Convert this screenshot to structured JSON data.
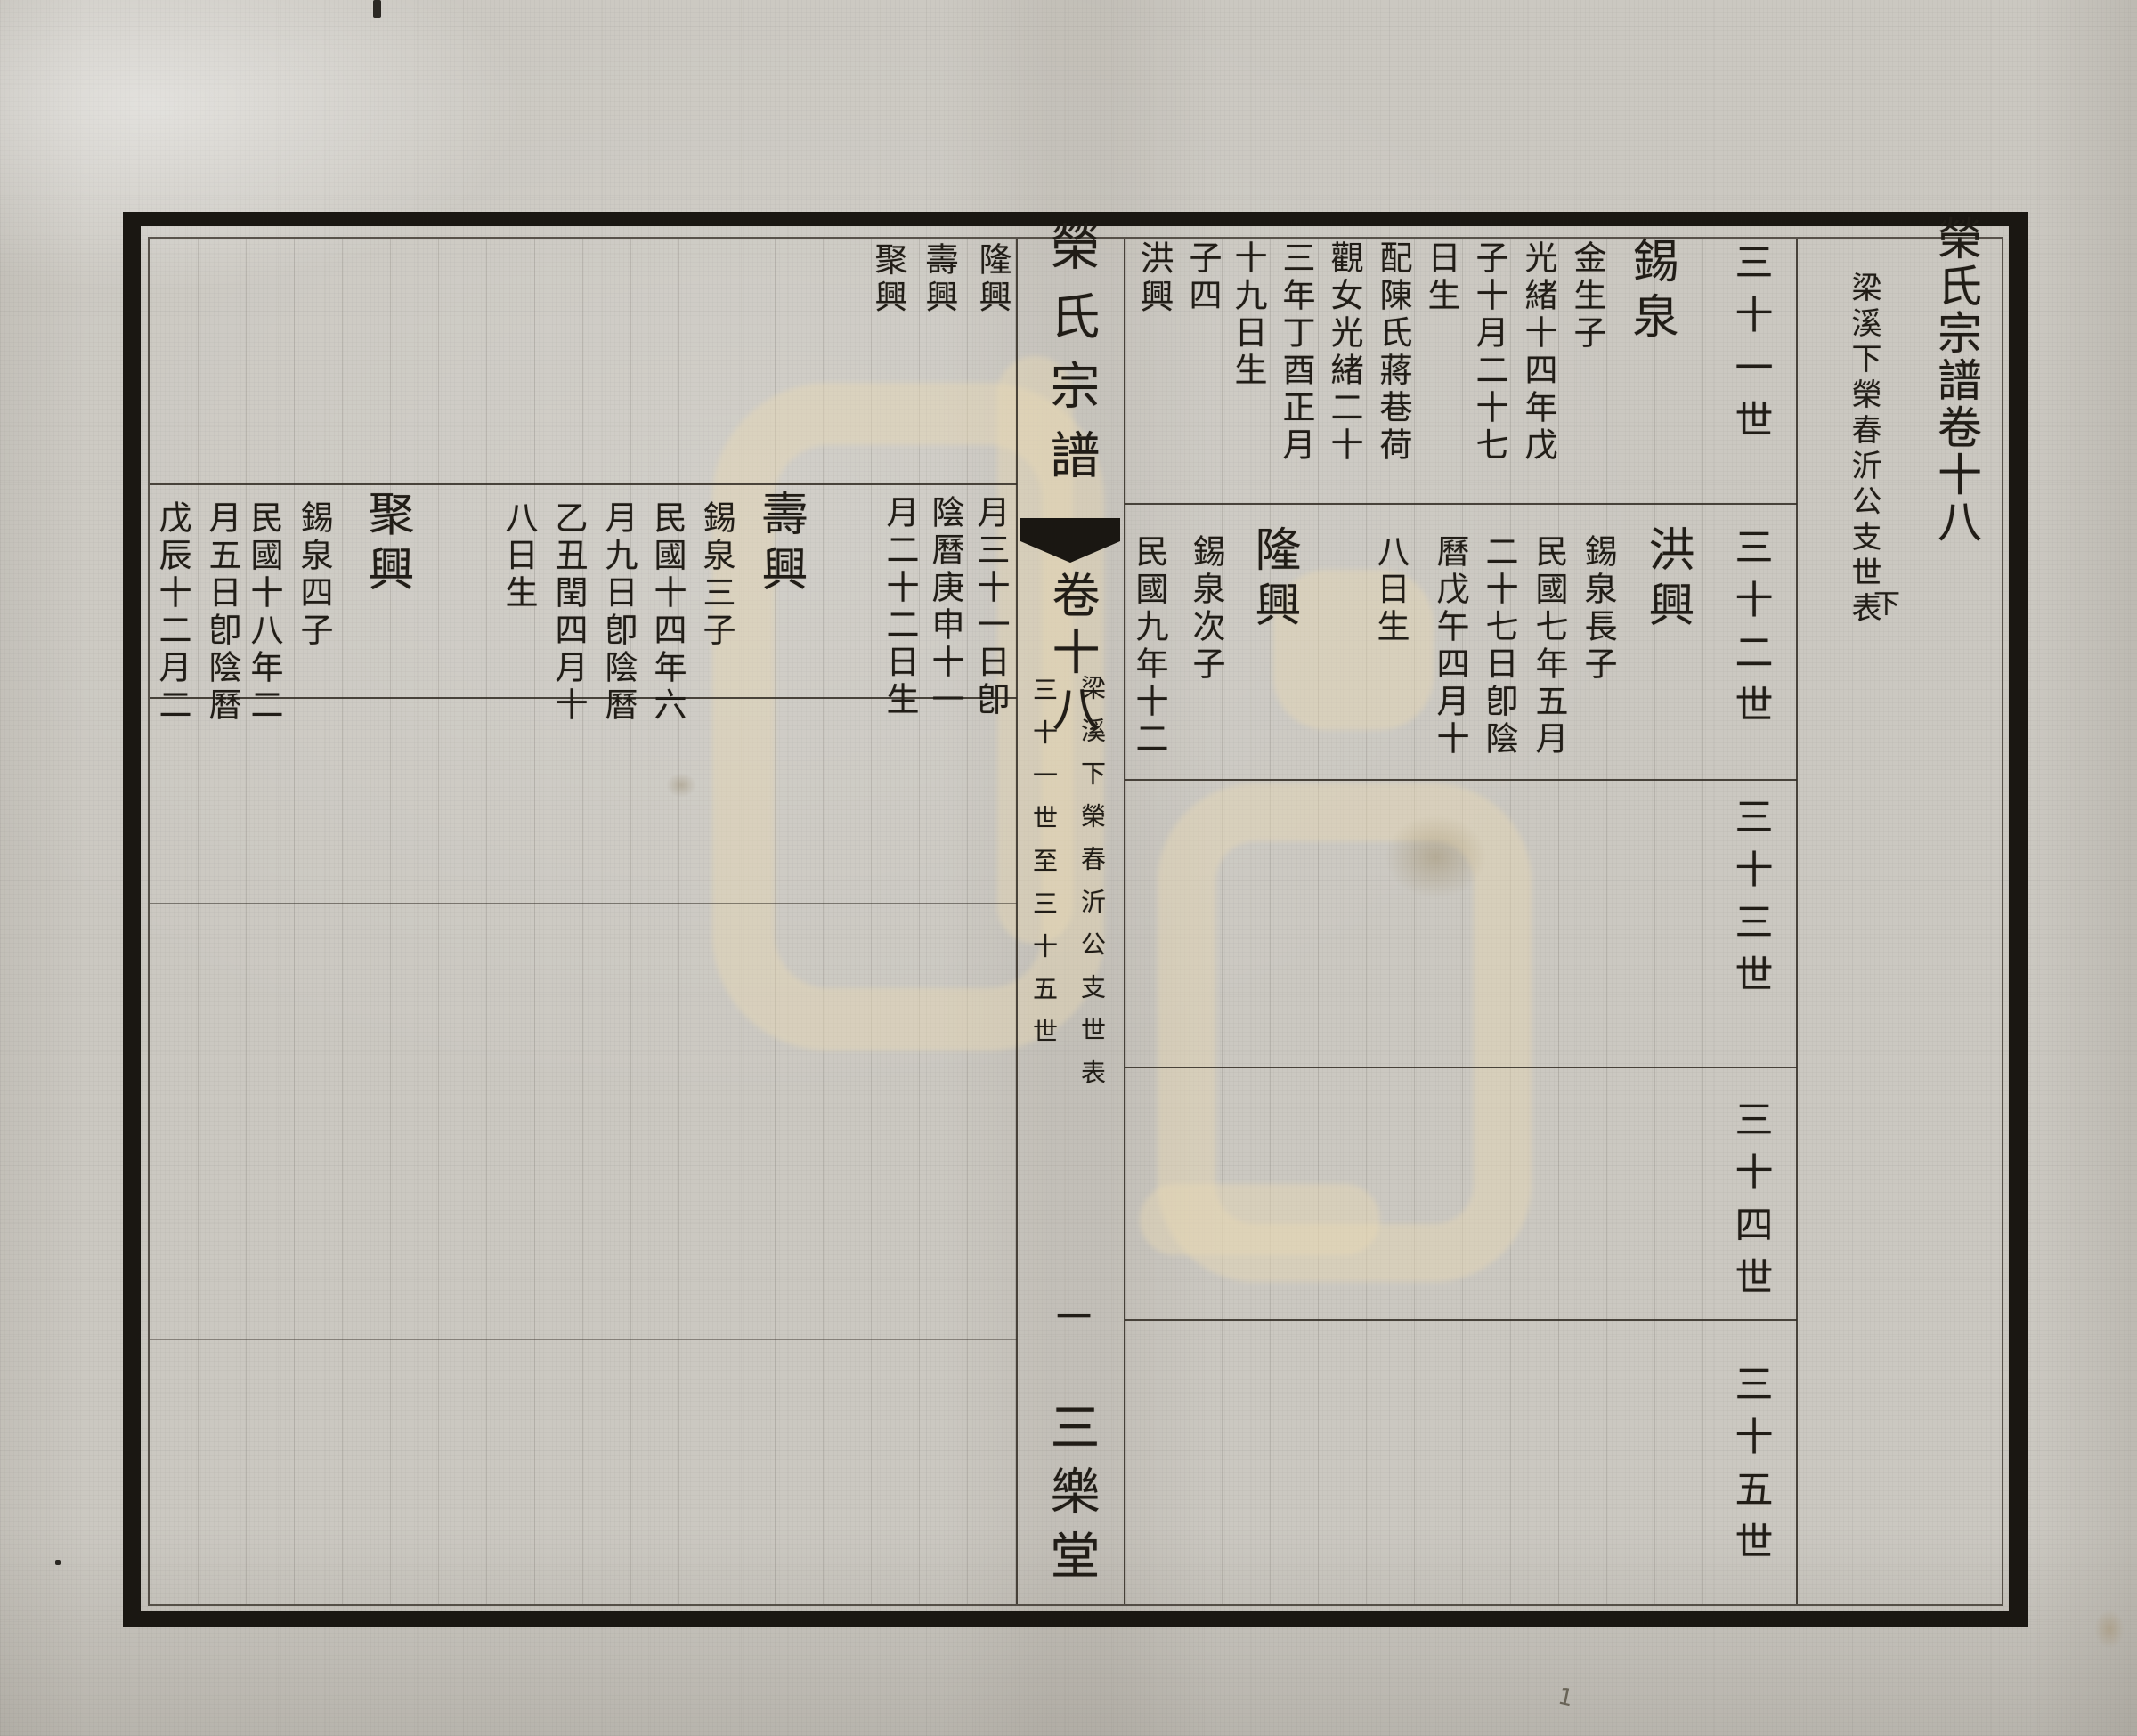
{
  "spine": {
    "title": "榮氏宗譜",
    "volume": "卷十八",
    "branch_note": "梁溪下榮春沂公支世表",
    "generation_range": "三十一世至三十五世",
    "page_number": "一",
    "hall_name": "三樂堂"
  },
  "right_page": {
    "header": {
      "title": "榮氏宗譜卷十八",
      "subtitle": "梁溪下榮春沂公支世表",
      "part": "下"
    },
    "generations": [
      "三十一世",
      "三十二世",
      "三十三世",
      "三十四世",
      "三十五世"
    ],
    "row1": {
      "entry": {
        "name": "錫泉",
        "columns": [
          "金生子",
          "光緒十四年戊",
          "子十月二十七",
          "日生",
          "配陳氏蔣巷荷",
          "觀女光緒二十",
          "三年丁酉正月",
          "十九日生",
          "子四"
        ]
      },
      "sons": [
        "洪興"
      ]
    },
    "row2": {
      "entries": [
        {
          "name": "洪興",
          "columns": [
            "錫泉長子",
            "民國七年五月",
            "二十七日卽陰",
            "曆戊午四月十",
            "八日生"
          ]
        },
        {
          "name": "隆興",
          "columns": [
            "錫泉次子",
            "民國九年十二"
          ]
        }
      ]
    }
  },
  "left_page": {
    "row1": {
      "sons_continued": [
        "隆興",
        "壽興",
        "聚興"
      ]
    },
    "row2": {
      "continuation": [
        "月三十一日卽",
        "陰曆庚申十一",
        "月二十二日生"
      ],
      "entries": [
        {
          "name": "壽興",
          "columns": [
            "錫泉三子",
            "民國十四年六",
            "月九日卽陰曆",
            "乙丑閏四月十",
            "八日生"
          ]
        },
        {
          "name": "聚興",
          "columns": [
            "錫泉四子",
            "民國十八年二",
            "月五日卽陰曆",
            "戊辰十二月二"
          ]
        }
      ]
    }
  },
  "annotations": {
    "pencil_mark": "1"
  }
}
